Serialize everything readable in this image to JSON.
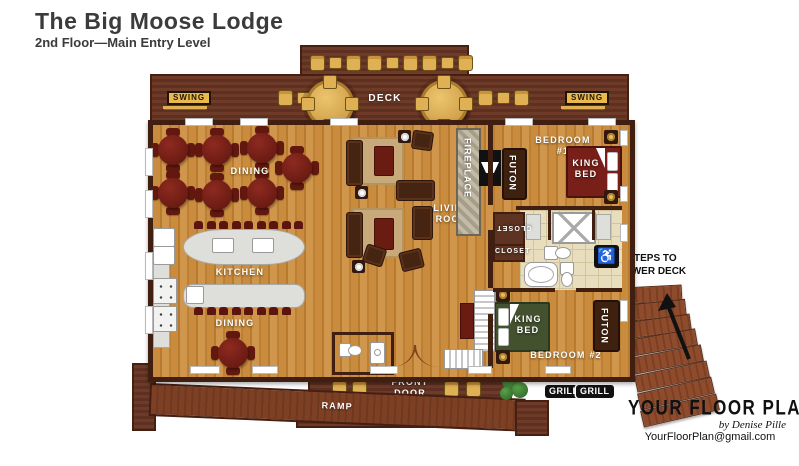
{
  "header": {
    "title": "The Big Moose Lodge",
    "subtitle": "2nd Floor—Main Entry Level"
  },
  "labels": {
    "deck": "DECK",
    "swing_left": "SWING",
    "swing_right": "SWING",
    "dining_upper": "DINING",
    "kitchen": "KITCHEN",
    "dining_lower": "DINING",
    "living_room": "LIVING ROOM",
    "fireplace": "FIREPLACE",
    "bedroom1": "BEDROOM #1",
    "futon1": "FUTON",
    "king_bed1": "KING BED",
    "closet_vertical": "CLOSET",
    "closet_horizontal": "CLOSET",
    "steps_to_lower_deck": "STEPS TO LOWER DECK",
    "king_bed2": "KING BED",
    "bedroom2": "BEDROOM #2",
    "futon2": "FUTON",
    "front_door": "FRONT DOOR",
    "ramp": "RAMP",
    "grill_1": "GRILL",
    "grill_2": "GRILL"
  },
  "icons": {
    "accessible": "♿"
  },
  "logo": {
    "brand": "YOUR FLOOR PLAN",
    "byline": "by Denise Pille",
    "email": "YourFloorPlan@gmail.com"
  },
  "colors": {
    "wall": "#401f10",
    "deck": "#6f3b29",
    "deck_dark": "#5e3021",
    "gold": "#e0b054",
    "badge": "#e9b94d",
    "red": "#771f18",
    "green_bed": "#43512e",
    "futon": "#3f2110",
    "steps": "#8a4a2c"
  }
}
